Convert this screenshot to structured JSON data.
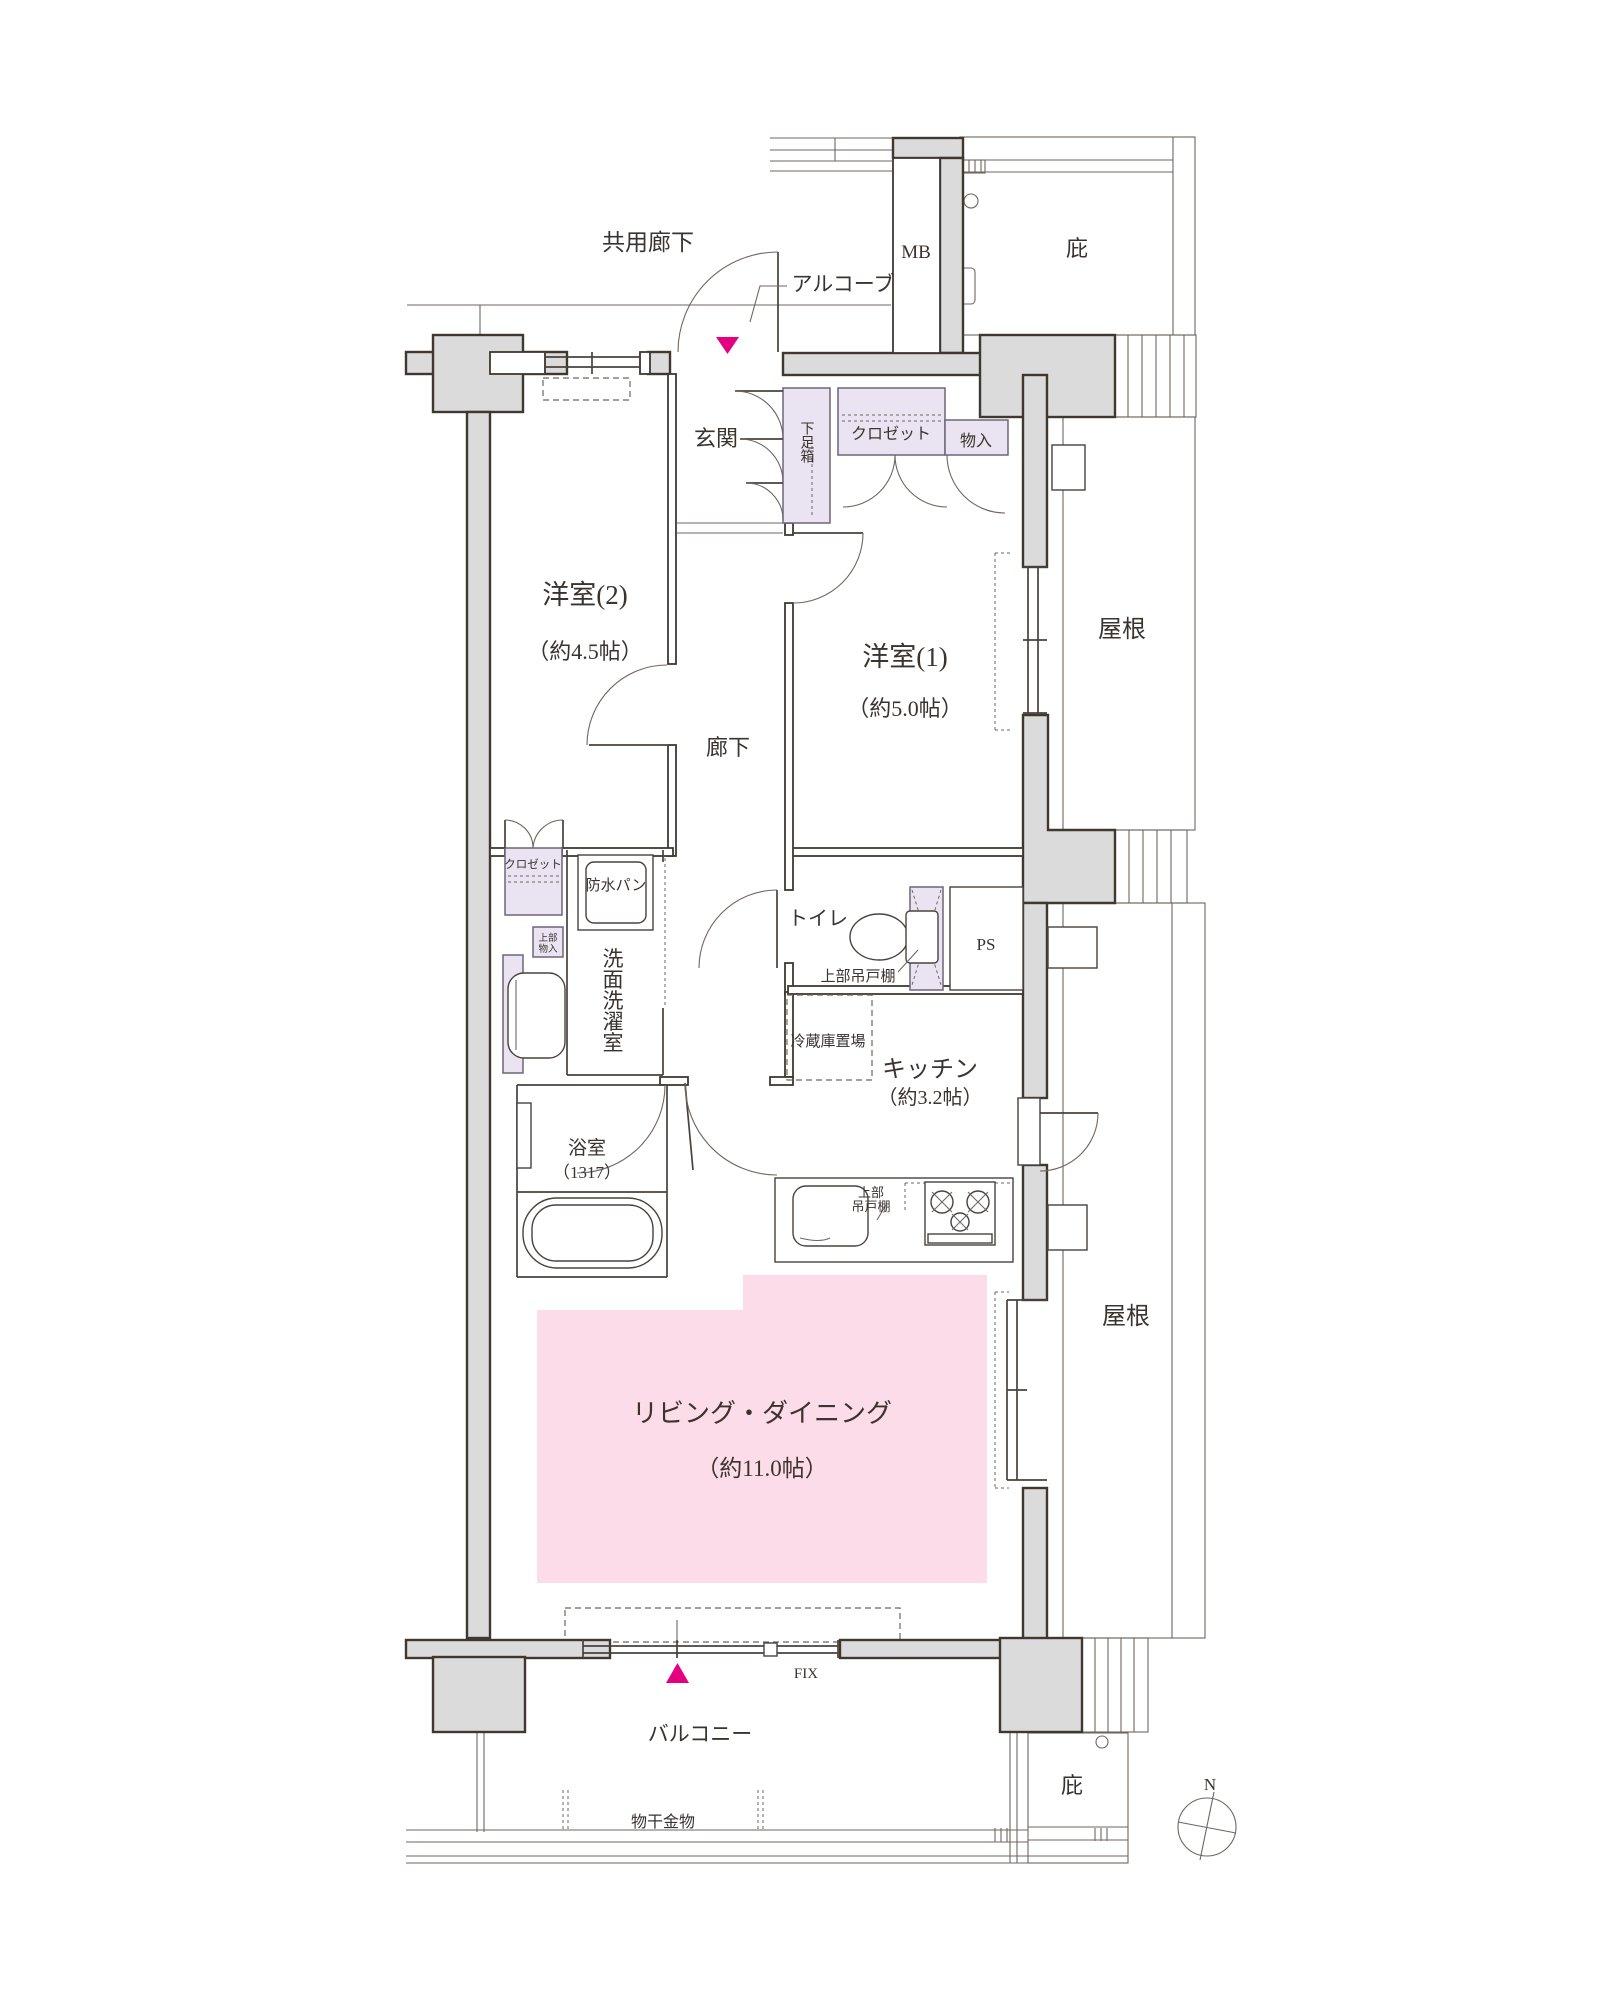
{
  "plan": {
    "type": "apartment-floor-plan",
    "colors": {
      "wall_fill": "#dbdbdb",
      "room_accent_pink": "#fbdce8",
      "fixture_purple": "#e9e3f2",
      "entry_marker_magenta": "#e4007f",
      "line": "#40382f"
    },
    "labels": {
      "common_corridor": "共用廊下",
      "alcove": "アルコーブ",
      "mb": "MB",
      "eaves_top": "庇",
      "entrance": "玄関",
      "shoe_box": "下足箱",
      "closet_hall": "クロゼット",
      "storage_hall": "物入",
      "western_room_2": "洋室(2)",
      "western_room_2_size": "（約4.5帖）",
      "western_room_1": "洋室(1)",
      "western_room_1_size": "（約5.0帖）",
      "hallway": "廊下",
      "roof_upper": "屋根",
      "roof_lower": "屋根",
      "closet_west_room_2": "クロゼット",
      "upper_storage_line1": "上部",
      "upper_storage_line2": "物入",
      "waterproof_pan": "防水パン",
      "washroom_laundry": "洗面洗濯室",
      "toilet": "トイレ",
      "upper_cabinet_toilet": "上部吊戸棚",
      "pipe_space": "PS",
      "fridge_space": "冷蔵庫置場",
      "kitchen": "キッチン",
      "kitchen_size": "（約3.2帖）",
      "upper_cabinet_kitchen_line1": "上部",
      "upper_cabinet_kitchen_line2": "吊戸棚",
      "bathroom": "浴室",
      "bathroom_size": "（1317）",
      "living_dining": "リビング・ダイニング",
      "living_dining_size": "（約11.0帖）",
      "fix": "FIX",
      "balcony": "バルコニー",
      "laundry_hardware": "物干金物",
      "eaves_bottom": "庇",
      "compass_north": "N"
    }
  }
}
